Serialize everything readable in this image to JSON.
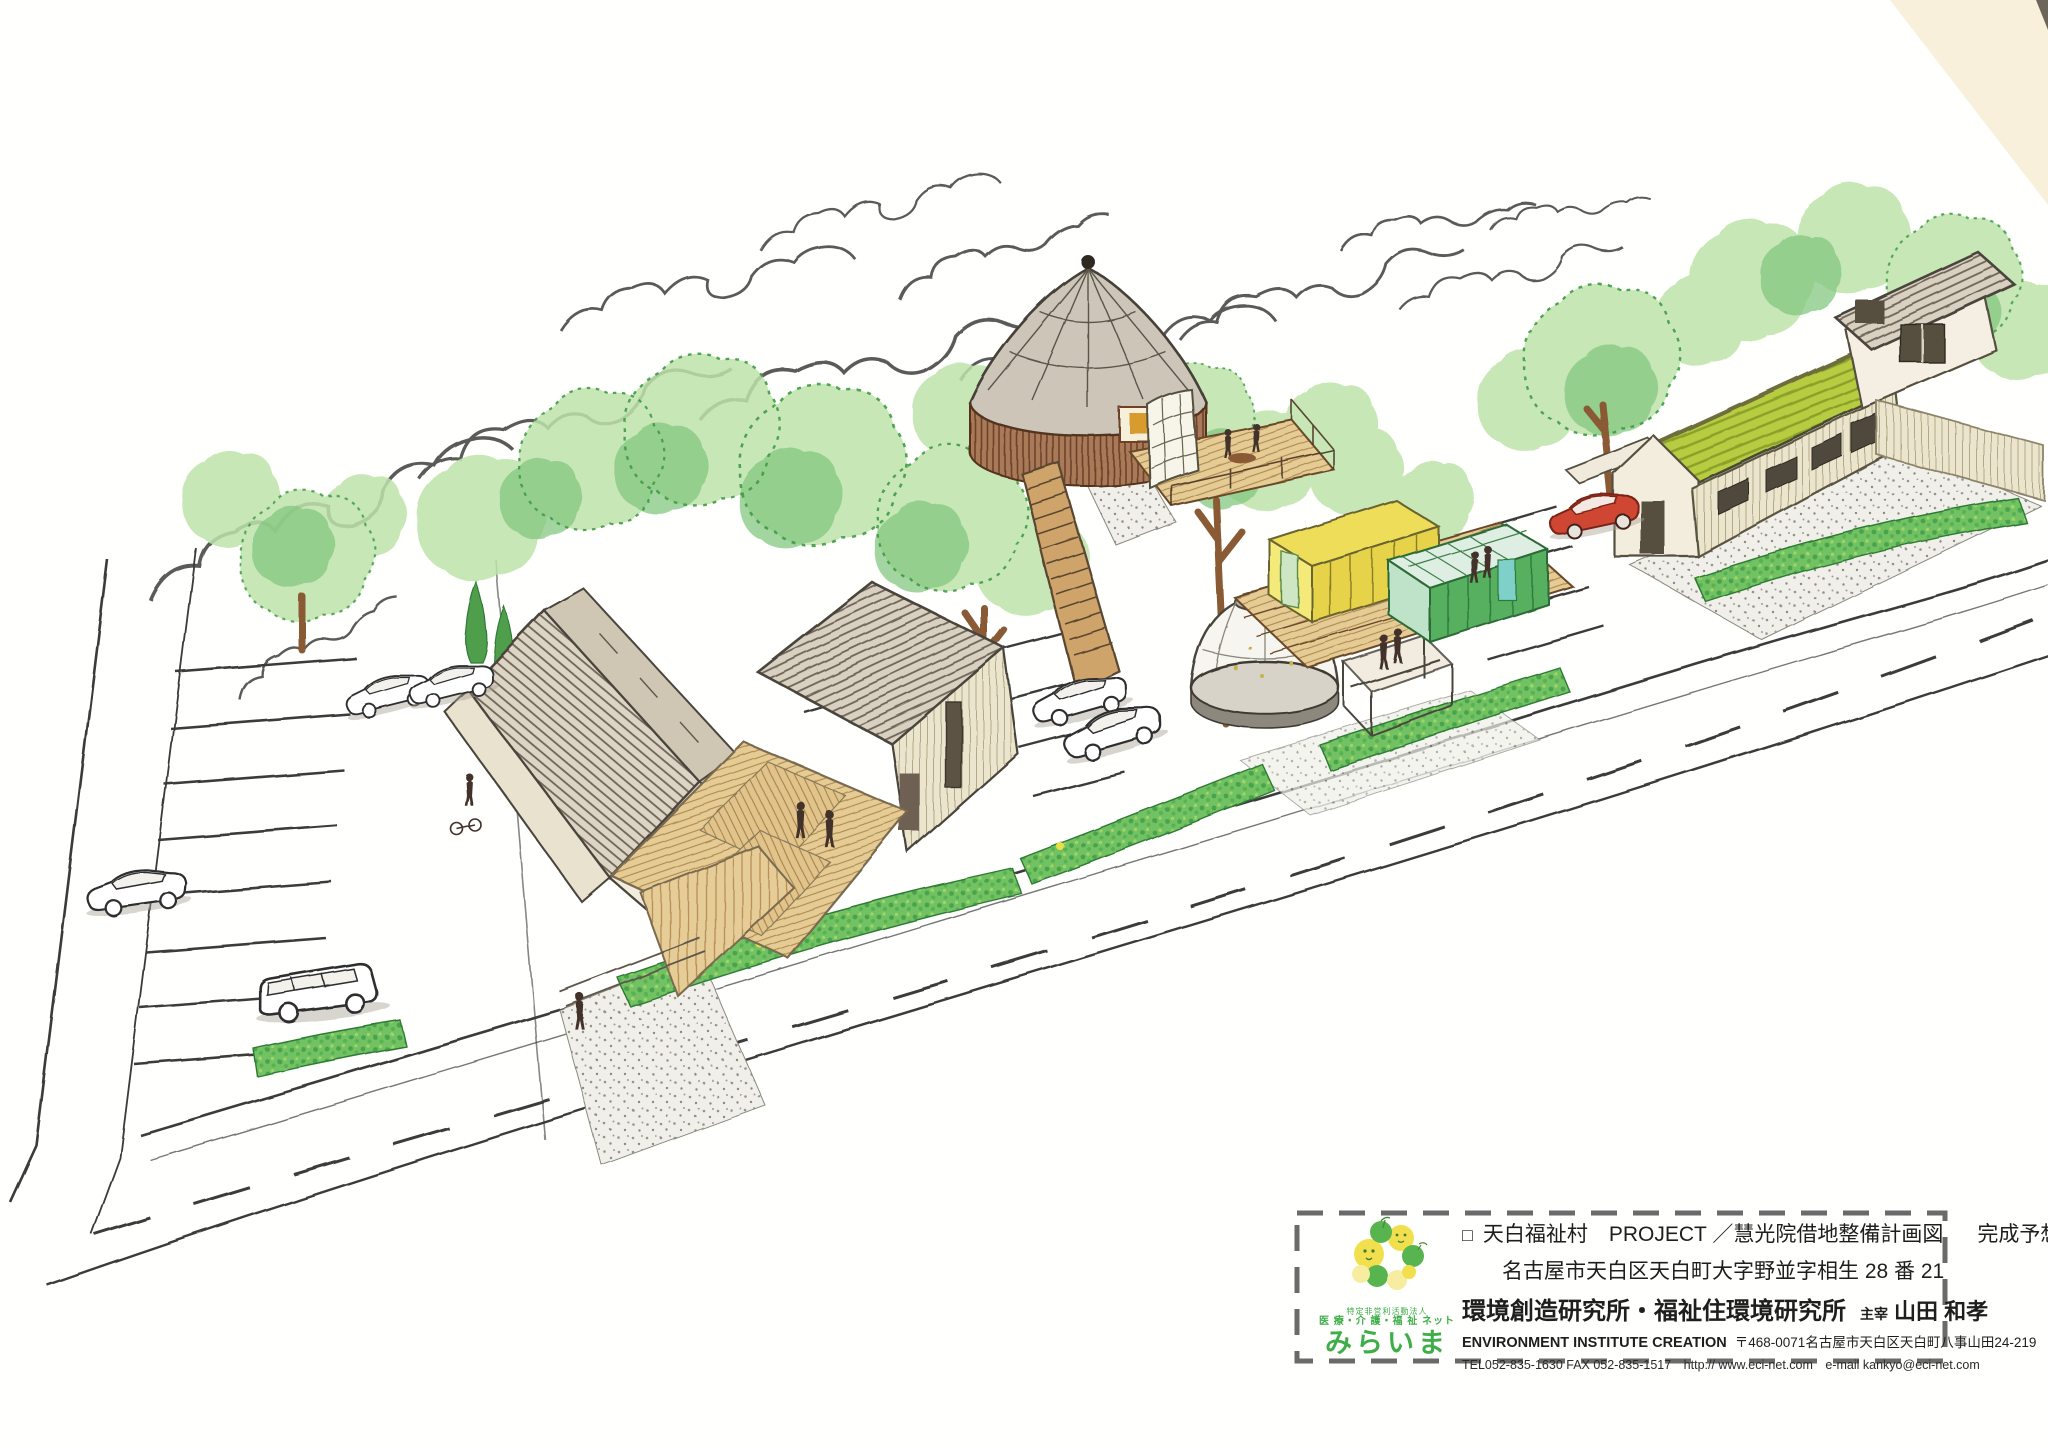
{
  "title_block": {
    "project_marker": "□",
    "project_title": "天白福祉村　PROJECT ／慧光院借地整備計画図",
    "drawing_type": "完成予想図",
    "site_address": "名古屋市天白区天白町大字野並字相生 28 番 21",
    "organization": "環境創造研究所・福祉住環境研究所",
    "principal_label": "主宰",
    "principal_name": "山田 和孝",
    "organization_en": "ENVIRONMENT INSTITUTE CREATION",
    "postal_address": "〒468-0071名古屋市天白区天白町八事山田24-219",
    "contact_line": "TEL052-835-1630 FAX 052-835-1517　http:// www.eci-net.com　e-mail kankyo@eci-net.com"
  },
  "logo": {
    "npo_type": "特定非営利活動法人",
    "npo_net": "医 療・介 護・福 祉 ネット",
    "name": "みらいま"
  },
  "palette": {
    "paper": "#fffffe",
    "paper_tint": "#f8edd6",
    "ink": "#3c3c3c",
    "tree_light": "#bfe3ab",
    "tree_mid": "#83c77f",
    "tree_dark": "#3f9b45",
    "hedge_green": "#72c263",
    "wood_light": "#e6cc96",
    "wood_mid": "#cfa46a",
    "roof_gray": "#dcd5c6",
    "pavilion_wall": "#a87a58",
    "dome_white": "#f6f5f0",
    "greenhouse_yellow": "#eedd58",
    "greenhouse_green": "#57b061",
    "green_roof": "#b8cc42",
    "gravel": "#f0efe9",
    "car_red": "#cf4732",
    "logo_green": "#3fae49",
    "logo_yellow": "#f2df4e"
  }
}
